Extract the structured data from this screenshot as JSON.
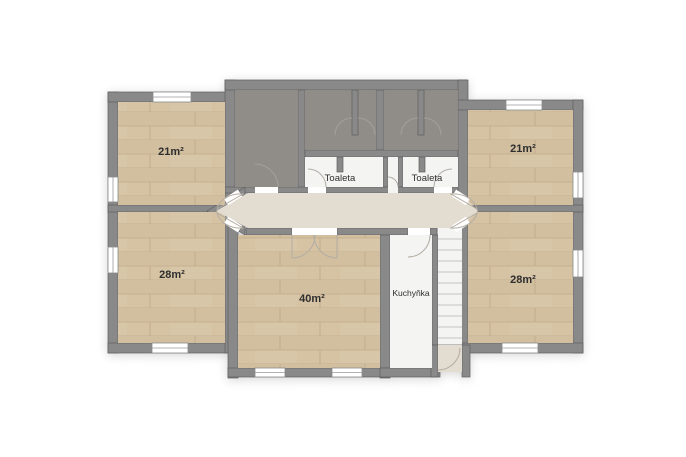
{
  "floorplan": {
    "type": "floor-plan",
    "rooms": [
      {
        "id": "room-top-left",
        "label": "21m²",
        "floor": "wood"
      },
      {
        "id": "room-top-right",
        "label": "21m²",
        "floor": "wood"
      },
      {
        "id": "room-mid-left",
        "label": "28m²",
        "floor": "wood"
      },
      {
        "id": "room-mid-right",
        "label": "28m²",
        "floor": "wood"
      },
      {
        "id": "room-bottom-center",
        "label": "40m²",
        "floor": "wood"
      },
      {
        "id": "toilet-left",
        "label": "Toaleta",
        "floor": "white"
      },
      {
        "id": "toilet-right",
        "label": "Toaleta",
        "floor": "white"
      },
      {
        "id": "kitchen",
        "label": "Kuchyňka",
        "floor": "white"
      }
    ],
    "colors": {
      "wall": "#898989",
      "wall_outline": "#5f5f5f",
      "wood_floor": "#d6c3a4",
      "wood_line": "#c6b190",
      "dark_room": "#908d89",
      "corridor": "#e3dcd1",
      "white_room": "#f4f4f3",
      "window": "#ffffff",
      "label_text": "#2e2e2e"
    }
  }
}
